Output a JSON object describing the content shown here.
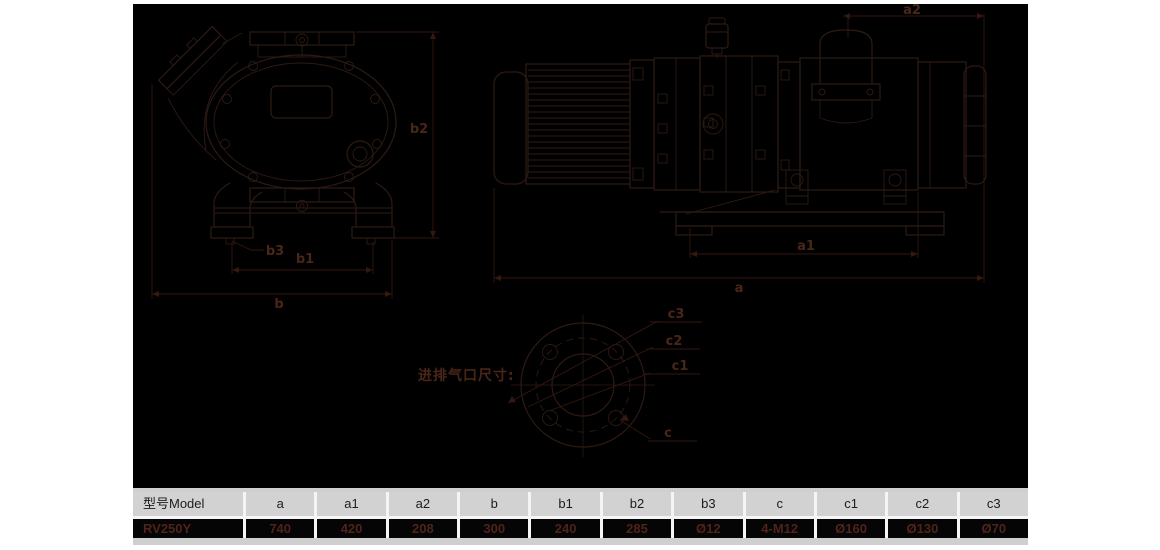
{
  "colors": {
    "page_bg": "#ffffff",
    "stage_bg": "#000000",
    "drawing_line": "#2e1a13",
    "dimension_label": "#4a2619",
    "table_header_bg": "#d2d2d2",
    "table_header_text": "#1c1c1c",
    "table_row_bg": "#050505",
    "table_value_text": "#4f231a"
  },
  "views": {
    "front": {
      "labels": {
        "b": "b",
        "b1": "b1",
        "b2": "b2",
        "b3": "b3"
      }
    },
    "side": {
      "labels": {
        "a": "a",
        "a1": "a1",
        "a2": "a2"
      }
    },
    "flange": {
      "caption": "进排气口尺寸:",
      "labels": {
        "c": "c",
        "c1": "c1",
        "c2": "c2",
        "c3": "c3"
      }
    }
  },
  "table": {
    "columns": [
      "型号Model",
      "a",
      "a1",
      "a2",
      "b",
      "b1",
      "b2",
      "b3",
      "c",
      "c1",
      "c2",
      "c3"
    ],
    "values": [
      "RV250Y",
      "740",
      "420",
      "208",
      "300",
      "240",
      "285",
      "Ø12",
      "4-M12",
      "Ø160",
      "Ø130",
      "Ø70"
    ]
  }
}
